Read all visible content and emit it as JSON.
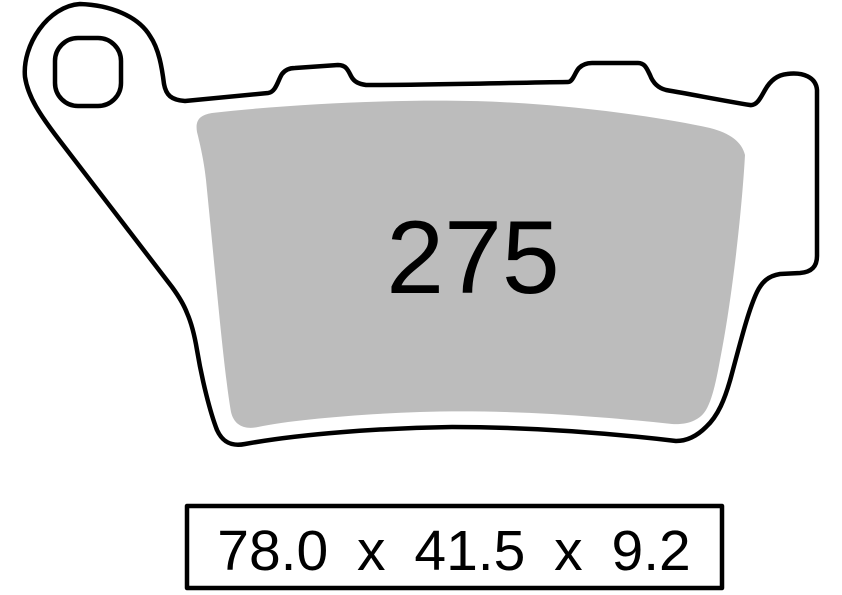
{
  "diagram": {
    "title": "brake-pad-technical-drawing",
    "pad_number": "275",
    "dimensions": "78.0 x 41.5 x 9.2"
  },
  "colors": {
    "outline": "#000000",
    "friction_material": "#bcbcbc",
    "backplate_fill": "#ffffff",
    "background": "#ffffff",
    "text": "#000000"
  }
}
